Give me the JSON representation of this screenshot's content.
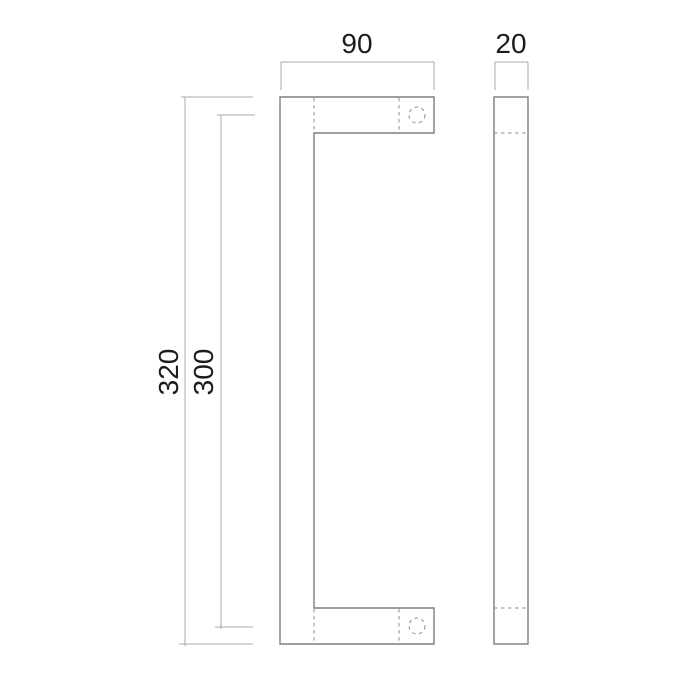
{
  "drawing": {
    "labels": {
      "width": "90",
      "depth": "20",
      "overall_height": "320",
      "hole_centers_height": "300"
    },
    "colors": {
      "background": "#ffffff",
      "part_outline": "#7d7d7d",
      "hidden_line": "#8c8c8c",
      "dimension_line": "#a9a9a9",
      "text": "#1c1c1c"
    }
  }
}
